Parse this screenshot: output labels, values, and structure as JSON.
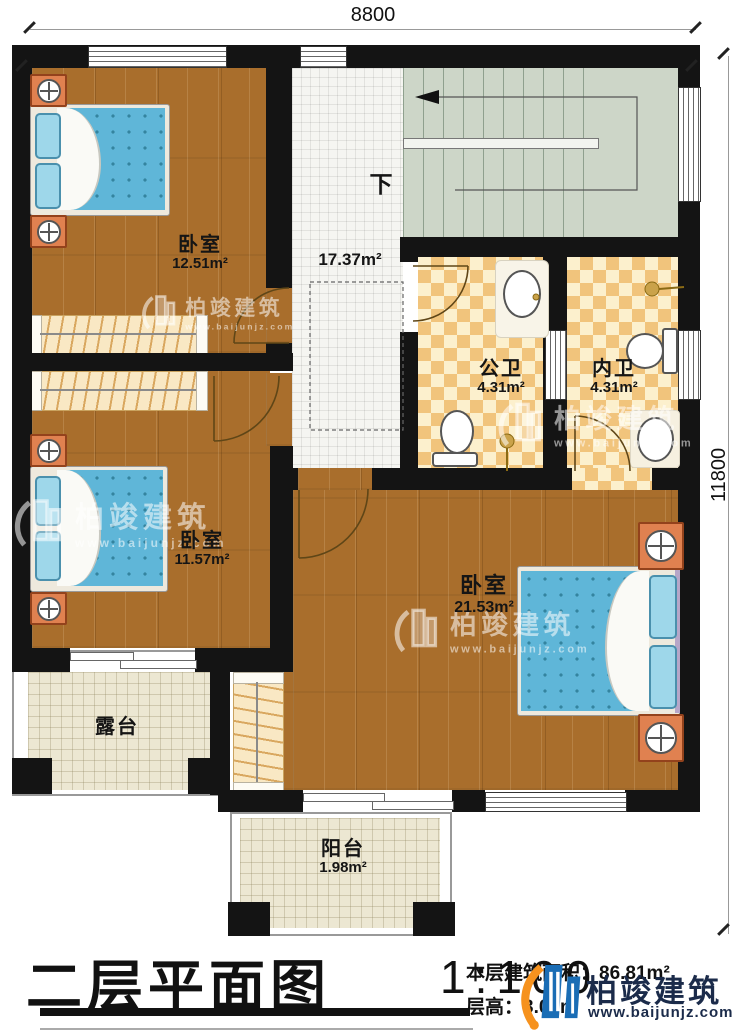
{
  "plan": {
    "dim_top": "8800",
    "dim_right": "11800",
    "stairs_down": "下",
    "hall_area": "17.37m²",
    "rooms": {
      "bedroom_top": {
        "name": "卧室",
        "area": "12.51m²"
      },
      "bedroom_left": {
        "name": "卧室",
        "area": "11.57m²"
      },
      "bedroom_master": {
        "name": "卧室",
        "area": "21.53m²"
      },
      "bath_public": {
        "name": "公卫",
        "area": "4.31m²"
      },
      "bath_inner": {
        "name": "内卫",
        "area": "4.31m²"
      },
      "terrace": {
        "name": "露台"
      },
      "balcony": {
        "name": "阳台",
        "area": "1.98m²"
      }
    }
  },
  "titleblock": {
    "title": "二层平面图",
    "scale": "1:100",
    "floor_area_label": "本层建筑面积：",
    "floor_area_value": "86.81m²",
    "floor_height_label": "层高：",
    "floor_height_value": "3.00m"
  },
  "brand": {
    "name": "柏竣建筑",
    "url": "www.baijunjz.com"
  },
  "colors": {
    "wall": "#141414",
    "wood_floor": "#a96e2c",
    "stairs": "#cdd6c8",
    "bath_tile_dark": "#f1c47c",
    "bath_tile_light": "#fcf0cd",
    "bed_blue": "#5fb6d8",
    "logo_blue": "#1a6db5",
    "logo_orange": "#f6921e",
    "logo_text": "#1b2b4a"
  }
}
